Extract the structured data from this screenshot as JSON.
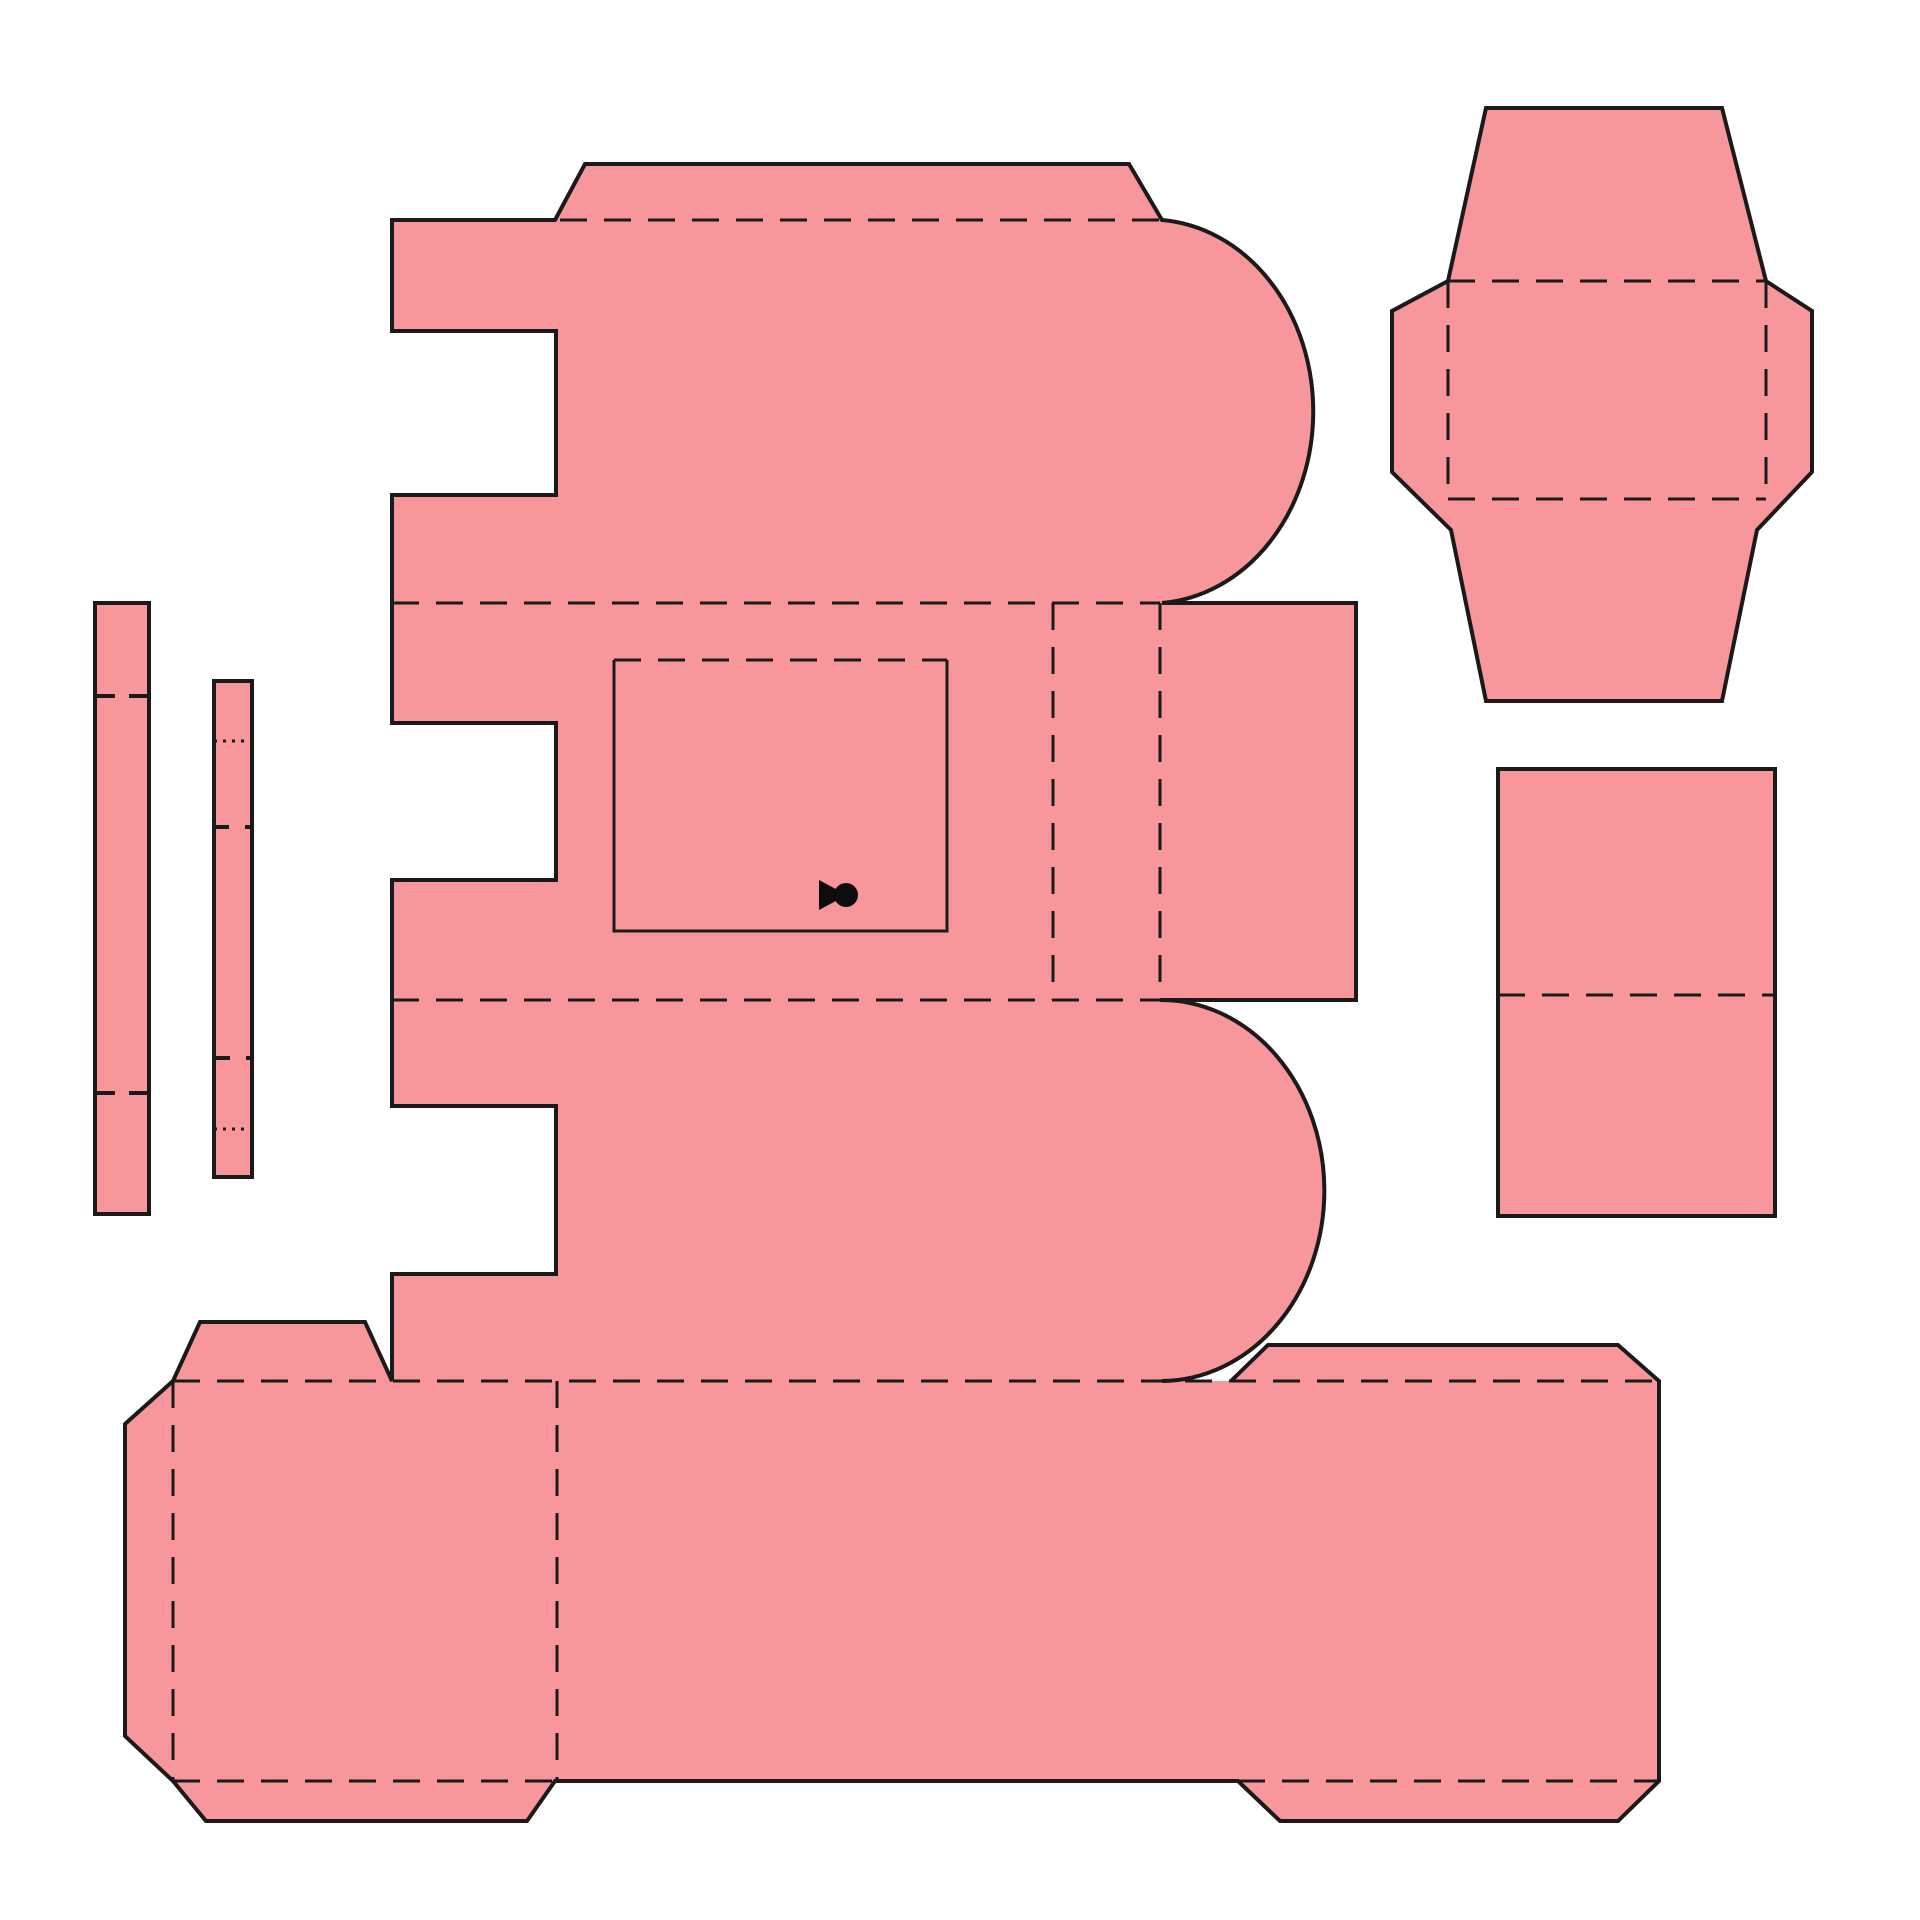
{
  "canvas": {
    "width": 1920,
    "height": 1920,
    "background": "#ffffff"
  },
  "style": {
    "paper_fill": "#F7969B",
    "line_color": "#1a1a1a",
    "ink_color": "#0d0d0d",
    "cut_width": 4,
    "fold_width": 3,
    "tick_width": 4,
    "fold_dash": "27 17",
    "dot_dash": "3 6"
  },
  "icons": {
    "keyhole": {
      "name": "keyhole-icon",
      "triangle": "M 819 880 L 847 895 L 819 910 Z",
      "circle": {
        "cx": 846,
        "cy": 895,
        "r": 12
      }
    }
  },
  "pieces": [
    {
      "id": "main-body-with-base-strip",
      "body": "M 1231 1381 L 1268 1345 L 1618 1345 L 1659 1381 L 1659 1781 L 1618 1821 L 1280 1821 L 1238 1781 L 555 1781 L 527 1821 L 206 1821 L 173 1781 L 125 1736 L 125 1424 L 173 1381 L 200 1322 L 365 1322 L 392 1381 L 392 1274 L 556 1274 L 556 1106 L 392 1106 L 392 880 L 556 880 L 556 723 L 392 723 L 392 495 L 556 495 L 556 331 L 392 331 L 392 220 L 555 220 L 585 164 L 1129 164 L 1162 220 A 163 192 0 0 1 1162 603 L 1356 603 L 1356 1000 L 1160 1000 A 163 190 0 0 1 1162 1381",
      "cuts": [
        "M 614 660 L 614 931 L 947 931 L 947 660"
      ],
      "folds": [
        "M 560 220 L 1162 220",
        "M 392 603 L 1160 603",
        "M 392 1000 L 1160 1000",
        "M 1053 603 L 1053 1000",
        "M 1160 603 L 1160 1000",
        "M 614 660 L 947 660",
        "M 173 1381 L 1659 1381",
        "M 173 1381 L 173 1781",
        "M 557 1381 L 557 1781",
        "M 173 1781 L 555 1781",
        "M 1238 1781 L 1659 1781"
      ],
      "dots": [],
      "ticks": []
    },
    {
      "id": "lid-flap-piece",
      "body": "M 1486 108 L 1722 108 L 1766 281 L 1812 311 L 1812 472 L 1757 530 L 1722 701 L 1486 701 L 1451 530 L 1392 472 L 1392 311 L 1448 281 Z",
      "cuts": [],
      "folds": [
        "M 1448 281 L 1766 281",
        "M 1448 499 L 1766 499",
        "M 1448 281 L 1448 499",
        "M 1766 281 L 1766 499"
      ],
      "dots": [],
      "ticks": []
    },
    {
      "id": "side-panel-piece",
      "body": "M 1498 769 L 1775 769 L 1775 1216 L 1498 1216 Z",
      "cuts": [],
      "folds": [
        "M 1498 995 L 1775 995"
      ],
      "dots": [],
      "ticks": []
    },
    {
      "id": "glue-strip-long",
      "body": "M 95 603 L 149 603 L 149 1214 L 95 1214 Z",
      "cuts": [],
      "folds": [],
      "dots": [],
      "ticks": [
        "M 95 696 L 115 696",
        "M 129 696 L 149 696",
        "M 95 1093 L 115 1093",
        "M 129 1093 L 149 1093"
      ]
    },
    {
      "id": "glue-strip-short",
      "body": "M 214 681 L 252 681 L 252 1177 L 214 1177 Z",
      "cuts": [],
      "folds": [],
      "dots": [
        "M 214 741 L 252 741",
        "M 214 1129 L 252 1129"
      ],
      "ticks": [
        "M 214 827 L 229 827",
        "M 245 827 L 252 827",
        "M 214 1058 L 230 1058",
        "M 246 1058 L 252 1058"
      ]
    }
  ]
}
